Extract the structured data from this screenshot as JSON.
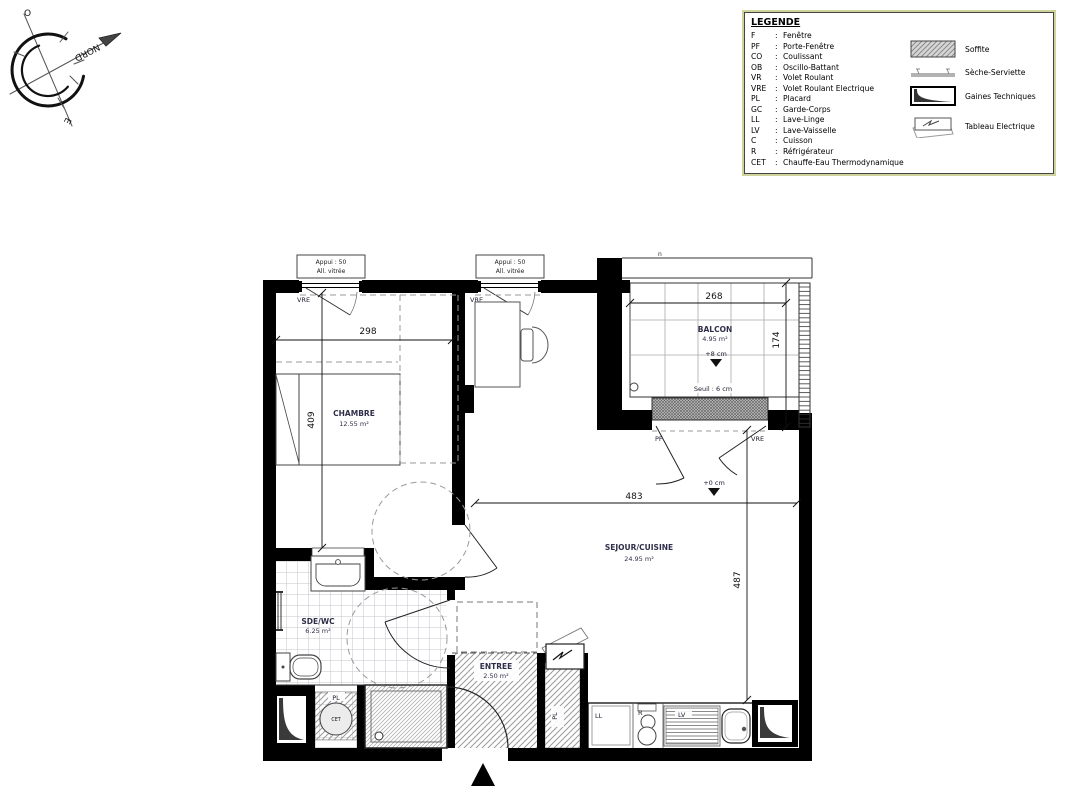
{
  "legend": {
    "title": "LEGENDE",
    "separator": ":",
    "abbreviations": [
      {
        "abbr": "F",
        "label": "Fenêtre"
      },
      {
        "abbr": "PF",
        "label": "Porte-Fenêtre"
      },
      {
        "abbr": "CO",
        "label": "Coulissant"
      },
      {
        "abbr": "OB",
        "label": "Oscillo-Battant"
      },
      {
        "abbr": "VR",
        "label": "Volet Roulant"
      },
      {
        "abbr": "VRE",
        "label": "Volet Roulant Electrique"
      },
      {
        "abbr": "PL",
        "label": "Placard"
      },
      {
        "abbr": "GC",
        "label": "Garde-Corps"
      },
      {
        "abbr": "LL",
        "label": "Lave-Linge"
      },
      {
        "abbr": "LV",
        "label": "Lave-Vaisselle"
      },
      {
        "abbr": "C",
        "label": "Cuisson"
      },
      {
        "abbr": "R",
        "label": "Réfrigérateur"
      },
      {
        "abbr": "CET",
        "label": "Chauffe-Eau Thermodynamique"
      }
    ],
    "symbols": [
      {
        "name": "soffite-swatch",
        "label": "Soffite"
      },
      {
        "name": "seche-serviette-symbol",
        "label": "Sèche-Serviette"
      },
      {
        "name": "gaines-techniques-symbol",
        "label": "Gaines Techniques"
      },
      {
        "name": "tableau-electrique-symbol",
        "label": "Tableau Electrique"
      }
    ]
  },
  "compass": {
    "north": "NORD",
    "west": "O",
    "east": "E"
  },
  "rooms": {
    "chambre": {
      "name": "CHAMBRE",
      "area": "12.55 m²"
    },
    "sejour": {
      "name": "SEJOUR/CUISINE",
      "area": "24.95 m²"
    },
    "balcon": {
      "name": "BALCON",
      "area": "4.95 m²"
    },
    "sde": {
      "name": "SDE/WC",
      "area": "6.25 m²"
    },
    "entree": {
      "name": "ENTREE",
      "area": "2.50 m²"
    }
  },
  "dimensions": {
    "chambre_width": "298",
    "chambre_height": "409",
    "balcon_width": "268",
    "balcon_height": "174",
    "sejour_width": "483",
    "sejour_height": "487"
  },
  "annotations": {
    "appui_line1": "Appui : 50",
    "appui_line2": "All. vitrée",
    "vre": "VRE",
    "pf": "PF",
    "pl": "PL",
    "ll": "LL",
    "lv": "LV",
    "r": "R",
    "cet": "CET",
    "seuil": "Seuil : 6 cm",
    "level_balcon": "+8 cm",
    "level_sejour": "+0 cm",
    "north_mark": "n"
  },
  "colors": {
    "wall": "#000000",
    "legend_border": "#d0d49c",
    "room_text": "#2e2e4a"
  }
}
